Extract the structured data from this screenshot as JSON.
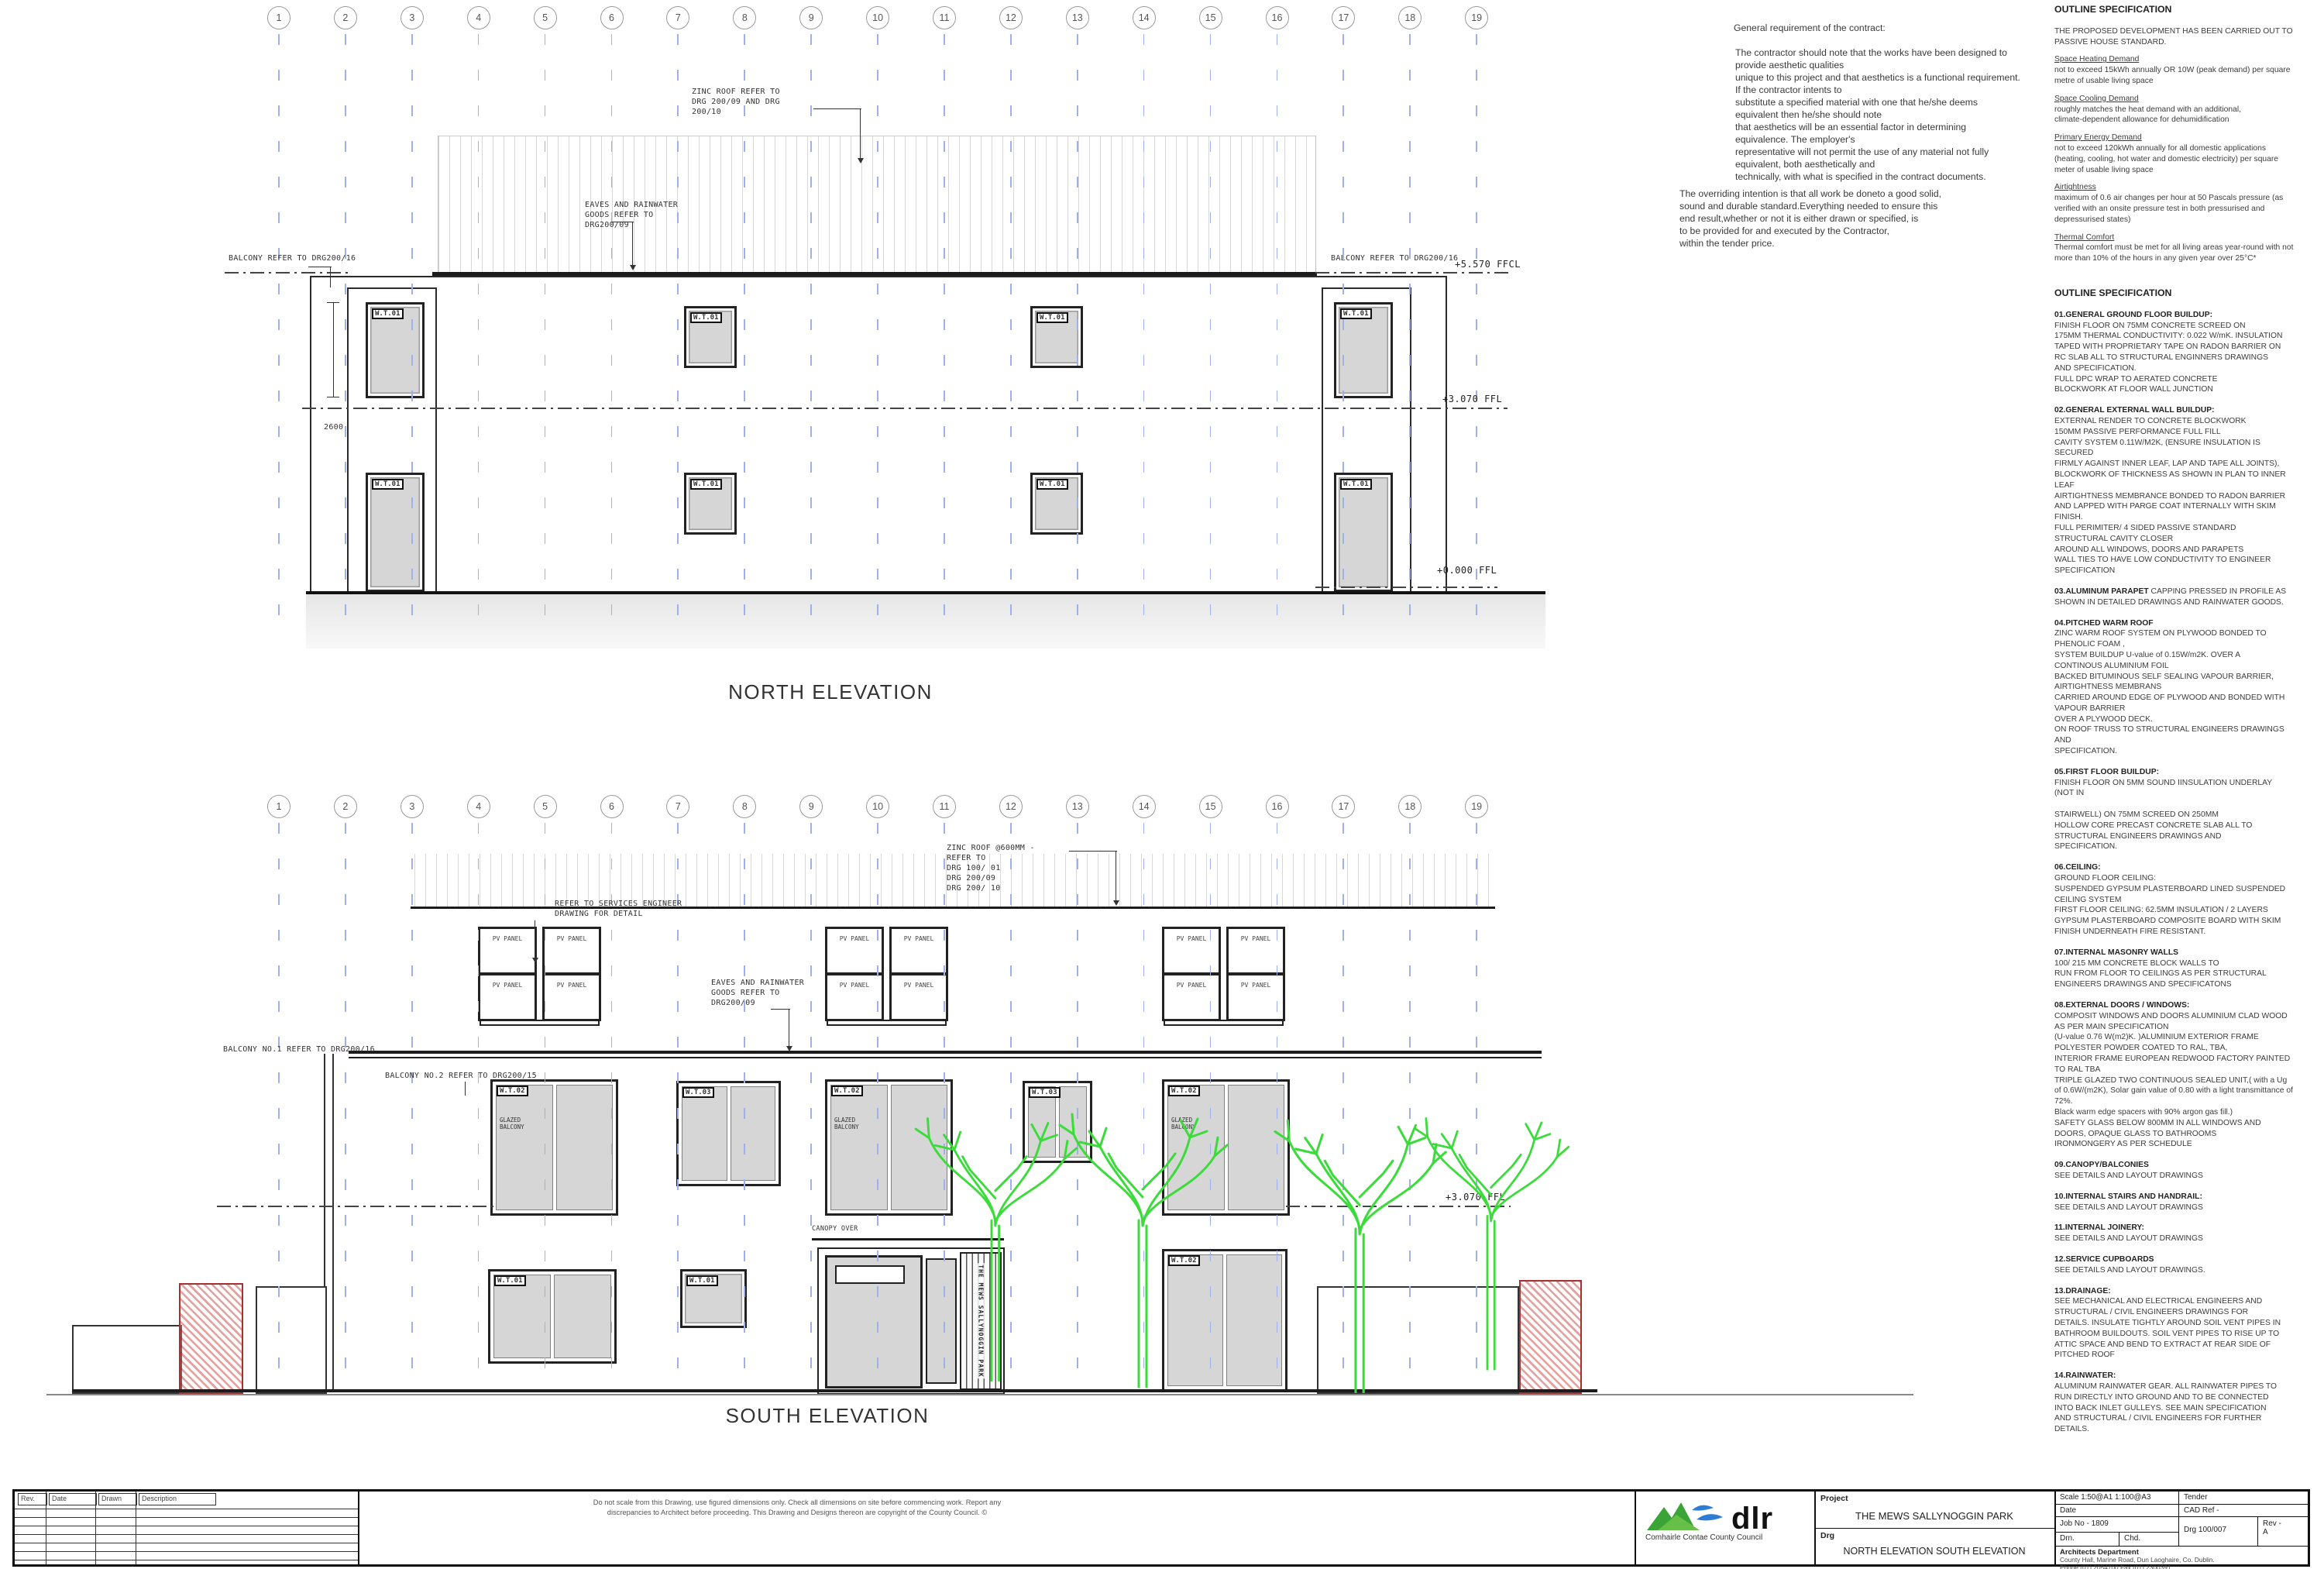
{
  "grid": {
    "labels": [
      "1",
      "2",
      "3",
      "4",
      "5",
      "6",
      "7",
      "8",
      "9",
      "10",
      "11",
      "12",
      "13",
      "14",
      "15",
      "16",
      "17",
      "18",
      "19"
    ]
  },
  "tags": {
    "wt01": "W.T.01",
    "wt02": "W.T.02",
    "wt03": "W.T.03"
  },
  "levels": {
    "ffcl": "+5.570 FFCL",
    "ff1": "+3.070 FFL",
    "ff0": "+0.000 FFL"
  },
  "north": {
    "title": "NORTH ELEVATION",
    "zinc_roof": "ZINC ROOF REFER  TO\nDRG 200/09 AND DRG\n200/10",
    "eaves": "EAVES AND RAINWATER\nGOODS REFER TO\nDRG200/09",
    "balcony": "BALCONY REFER TO DRG200/16",
    "dim": "2600"
  },
  "south": {
    "title": "SOUTH ELEVATION",
    "zinc_roof": "ZINC ROOF @600MM -\nREFER  TO\nDRG 100/ 01\nDRG 200/09\nDRG 200/ 10",
    "services": "REFER TO SERVICES ENGINEER\nDRAWING FOR DETAIL",
    "eaves": "EAVES AND RAINWATER\nGOODS REFER TO\nDRG200/09",
    "balcony1": "BALCONY NO.1 REFER TO DRG200/16",
    "balcony2": "BALCONY NO.2 REFER TO DRG200/15",
    "canopy": "CANOPY OVER",
    "pv": "PV PANEL",
    "glazed": "GLAZED\nBALCONY",
    "door_sign": "THE MEWS SALLYNOGGIN PARK"
  },
  "contract": {
    "title": "General requirement of the contract:",
    "p1": "The contractor should note that the works have been designed to\nprovide aesthetic qualities\nunique to this project and that aesthetics is a functional requirement.\nIf the contractor intents to\nsubstitute a specified material with one that he/she deems\nequivalent then he/she should note\nthat aesthetics will be an essential factor in determining\nequivalence. The employer's\nrepresentative will not permit the use of any material not fully\nequivalent, both aesthetically and\ntechnically, with what is specified in the contract documents.",
    "p2": "The overriding intention is that all work be doneto a good solid,\nsound and durable standard.Everything needed to ensure this\nend result,whether or not it is either drawn or specified, is\nto be provided for and executed by the Contractor,\nwithin the tender price."
  },
  "spec1": {
    "title": "OUTLINE SPECIFICATION",
    "intro": "THE PROPOSED DEVELOPMENT HAS BEEN CARRIED OUT TO\nPASSIVE HOUSE STANDARD.",
    "items": [
      {
        "h": "Space Heating Demand",
        "b": "not to exceed 15kWh annually OR 10W (peak demand) per square\nmetre of usable living space"
      },
      {
        "h": "Space Cooling Demand",
        "b": "roughly matches the heat demand with an additional,\nclimate-dependent allowance for dehumidification"
      },
      {
        "h": "Primary Energy Demand",
        "b": "not to exceed 120kWh annually for all domestic applications\n(heating, cooling, hot water and domestic electricity) per square\nmeter of usable living space"
      },
      {
        "h": "Airtightness",
        "b": "maximum of 0.6 air changes per hour at 50 Pascals pressure (as\nverified with an onsite pressure test in both pressurised and\ndepressurised states)"
      },
      {
        "h": "Thermal Comfort",
        "b": "Thermal comfort must be met for all living areas year-round with not\nmore than 10% of the hours in any given year over 25°C*"
      }
    ]
  },
  "spec2": {
    "title": "OUTLINE SPECIFICATION",
    "sections": [
      {
        "h": "01.GENERAL GROUND FLOOR BUILDUP:",
        "b": "\nFINISH FLOOR ON 75MM CONCRETE SCREED ON\n175MM THERMAL CONDUCTIVITY: 0.022 W/mK. INSULATION\nTAPED WITH PROPRIETARY TAPE ON RADON BARRIER ON\nRC SLAB ALL TO STRUCTURAL ENGINNERS DRAWINGS\nAND SPECIFICATION.\nFULL DPC WRAP TO AERATED CONCRETE\nBLOCKWORK  AT FLOOR WALL JUNCTION"
      },
      {
        "h": "02.GENERAL EXTERNAL WALL BUILDUP:",
        "b": "\nEXTERNAL RENDER TO CONCRETE BLOCKWORK\n150MM PASSIVE PERFORMANCE FULL FILL\nCAVITY SYSTEM 0.11W/M2K, (ENSURE INSULATION IS\nSECURED\nFIRMLY AGAINST INNER LEAF, LAP AND TAPE ALL JOINTS),\nBLOCKWORK OF THICKNESS AS SHOWN IN PLAN TO INNER\nLEAF\nAIRTIGHTNESS MEMBRANCE BONDED TO RADON BARRIER\nAND LAPPED WITH PARGE COAT INTERNALLY WITH SKIM\nFINISH.\n FULL PERIMITER/ 4 SIDED PASSIVE STANDARD\nSTRUCTURAL CAVITY CLOSER\nAROUND ALL WINDOWS, DOORS AND PARAPETS\nWALL TIES TO HAVE LOW CONDUCTIVITY TO ENGINEER\nSPECIFICATION"
      },
      {
        "h": "03.ALUMINUM PARAPET",
        "b": " CAPPING PRESSED IN PROFILE AS\nSHOWN IN DETAILED DRAWINGS AND RAINWATER GOODS."
      },
      {
        "h": "04.PITCHED WARM ROOF",
        "b": "\nZINC WARM ROOF SYSTEM ON PLYWOOD BONDED TO\nPHENOLIC FOAM ,\n SYSTEM BUILDUP   U-value of 0.15W/m2K. OVER   A\nCONTINOUS ALUMINIUM FOIL\n BACKED BITUMINOUS SELF SEALING  VAPOUR BARRIER,\nAIRTIGHTNESS MEMBRANS\nCARRIED AROUND EDGE OF PLYWOOD AND BONDED WITH\nVAPOUR BARRIER\nOVER A PLYWOOD DECK.\nON ROOF TRUSS TO STRUCTURAL ENGINEERS DRAWINGS\nAND\nSPECIFICATION."
      },
      {
        "h": "05.FIRST FLOOR BUILDUP:",
        "b": "\n FINISH FLOOR ON 5MM SOUND IINSULATION UNDERLAY\n(NOT IN\n\nSTAIRWELL) ON 75MM SCREED ON 250MM\nHOLLOW CORE PRECAST CONCRETE SLAB ALL TO\nSTRUCTURAL ENGINEERS DRAWINGS AND\nSPECIFICATION."
      },
      {
        "h": "06.CEILING:",
        "b": "\nGROUND FLOOR CEILING:\n SUSPENDED GYPSUM PLASTERBOARD LINED SUSPENDED\nCEILING SYSTEM\nFIRST FLOOR CEILING: 62.5MM INSULATION / 2 LAYERS\nGYPSUM PLASTERBOARD COMPOSITE BOARD WITH SKIM\nFINISH UNDERNEATH FIRE RESISTANT."
      },
      {
        "h": "07.INTERNAL MASONRY WALLS",
        "b": "\n100/ 215 MM CONCRETE BLOCK WALLS TO\nRUN FROM FLOOR TO CEILINGS AS PER STRUCTURAL\nENGINEERS DRAWINGS AND SPECIFICATONS"
      },
      {
        "h": "08.EXTERNAL DOORS / WINDOWS:",
        "b": "\nCOMPOSIT WINDOWS AND DOORS  ALUMINIUM CLAD WOOD\nAS PER MAIN SPECIFICATION\n(U-value 0.76 W(m2)K. )ALUMINIUM  EXTERIOR FRAME\nPOLYESTER POWDER COATED TO RAL, TBA,\nINTERIOR FRAME EUROPEAN REDWOOD FACTORY PAINTED\nTO RAL TBA\nTRIPLE GLAZED TWO CONTINUOUS SEALED UNIT,( with a Ug\nof 0.6W/(m2K), Solar gain value of 0.80 with a light transmittance of\n72%.\n Black warm edge spacers with 90% argon gas fill.)\nSAFETY GLASS BELOW 800MM IN ALL WINDOWS AND\nDOORS, OPAQUE GLASS TO BATHROOMS\nIRONMONGERY AS PER SCHEDULE"
      },
      {
        "h": "09.CANOPY/BALCONIES",
        "b": "\nSEE DETAILS AND LAYOUT DRAWINGS"
      },
      {
        "h": "10.INTERNAL STAIRS AND HANDRAIL:",
        "b": "\nSEE DETAILS AND LAYOUT DRAWINGS"
      },
      {
        "h": "11.INTERNAL JOINERY:",
        "b": "\nSEE DETAILS AND LAYOUT DRAWINGS"
      },
      {
        "h": "12.SERVICE CUPBOARDS",
        "b": "\nSEE DETAILS AND LAYOUT DRAWINGS."
      },
      {
        "h": "13.DRAINAGE:",
        "b": "\nSEE MECHANICAL AND ELECTRICAL ENGINEERS AND\nSTRUCTURAL / CIVIL ENGINEERS DRAWINGS FOR\nDETAILS. INSULATE TIGHTLY AROUND SOIL VENT PIPES IN\nBATHROOM BUILDOUTS. SOIL VENT PIPES TO RISE UP TO\nATTIC SPACE AND BEND TO EXTRACT AT REAR SIDE OF\nPITCHED ROOF"
      },
      {
        "h": "14.RAINWATER:",
        "b": "\nALUMINUM RAINWATER GEAR. ALL RAINWATER PIPES TO\nRUN DIRECTLY INTO GROUND AND TO BE CONNECTED\nINTO BACK INLET GULLEYS. SEE MAIN SPECIFICATION\nAND STRUCTURAL / CIVIL ENGINEERS FOR FURTHER\nDETAILS."
      }
    ]
  },
  "titleblock": {
    "rev_headers": [
      "Rev.",
      "Date",
      "Drawn",
      "Description"
    ],
    "disclaimer": "Do not scale from this Drawing, use figured dimensions only. Check all dimensions on site before commencing work. Report any\ndiscrepancies to Architect before proceeding. This Drawing and Designs thereon are copyright of the County Council. ©",
    "logo_text": "dlr",
    "logo_tagline": "Comhairle Contae County Council",
    "project_label": "Project",
    "project_value": "THE MEWS SALLYNOGGIN PARK",
    "drg_label": "Drg",
    "drg_value": "NORTH ELEVATION SOUTH ELEVATION",
    "scale": "Scale  1:50@A1 1:100@A3",
    "status": "Tender",
    "date_label": "Date",
    "cad_ref": "CAD Ref -",
    "job_no": "Job No - 1809",
    "drg_no": "Drg 100/007",
    "rev": "Rev -\nA",
    "drn": "Drn.",
    "chd": "Chd.",
    "dept": "Architects Department",
    "dept_addr": "County Hall, Marine Road, Dun Laoghaire, Co. Dublin.\nPhone (01) 2054700  Fax (01) 2300391"
  }
}
